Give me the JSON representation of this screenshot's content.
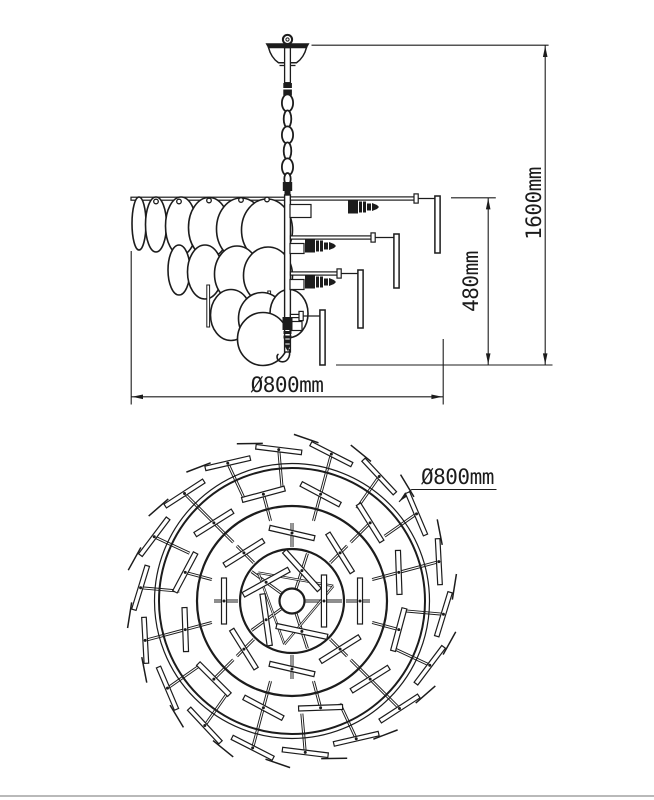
{
  "drawing": {
    "kind": "chandelier technical drawing, side elevation and top plan view"
  },
  "labels": {
    "side_diameter": "Ø800mm",
    "side_body_height": "480mm",
    "side_overall_height": "1600mm",
    "top_diameter": "Ø800mm"
  },
  "colors": {
    "line": "#1c1c1c",
    "background": "#ffffff",
    "footer_rule": "#b9b9b9"
  }
}
